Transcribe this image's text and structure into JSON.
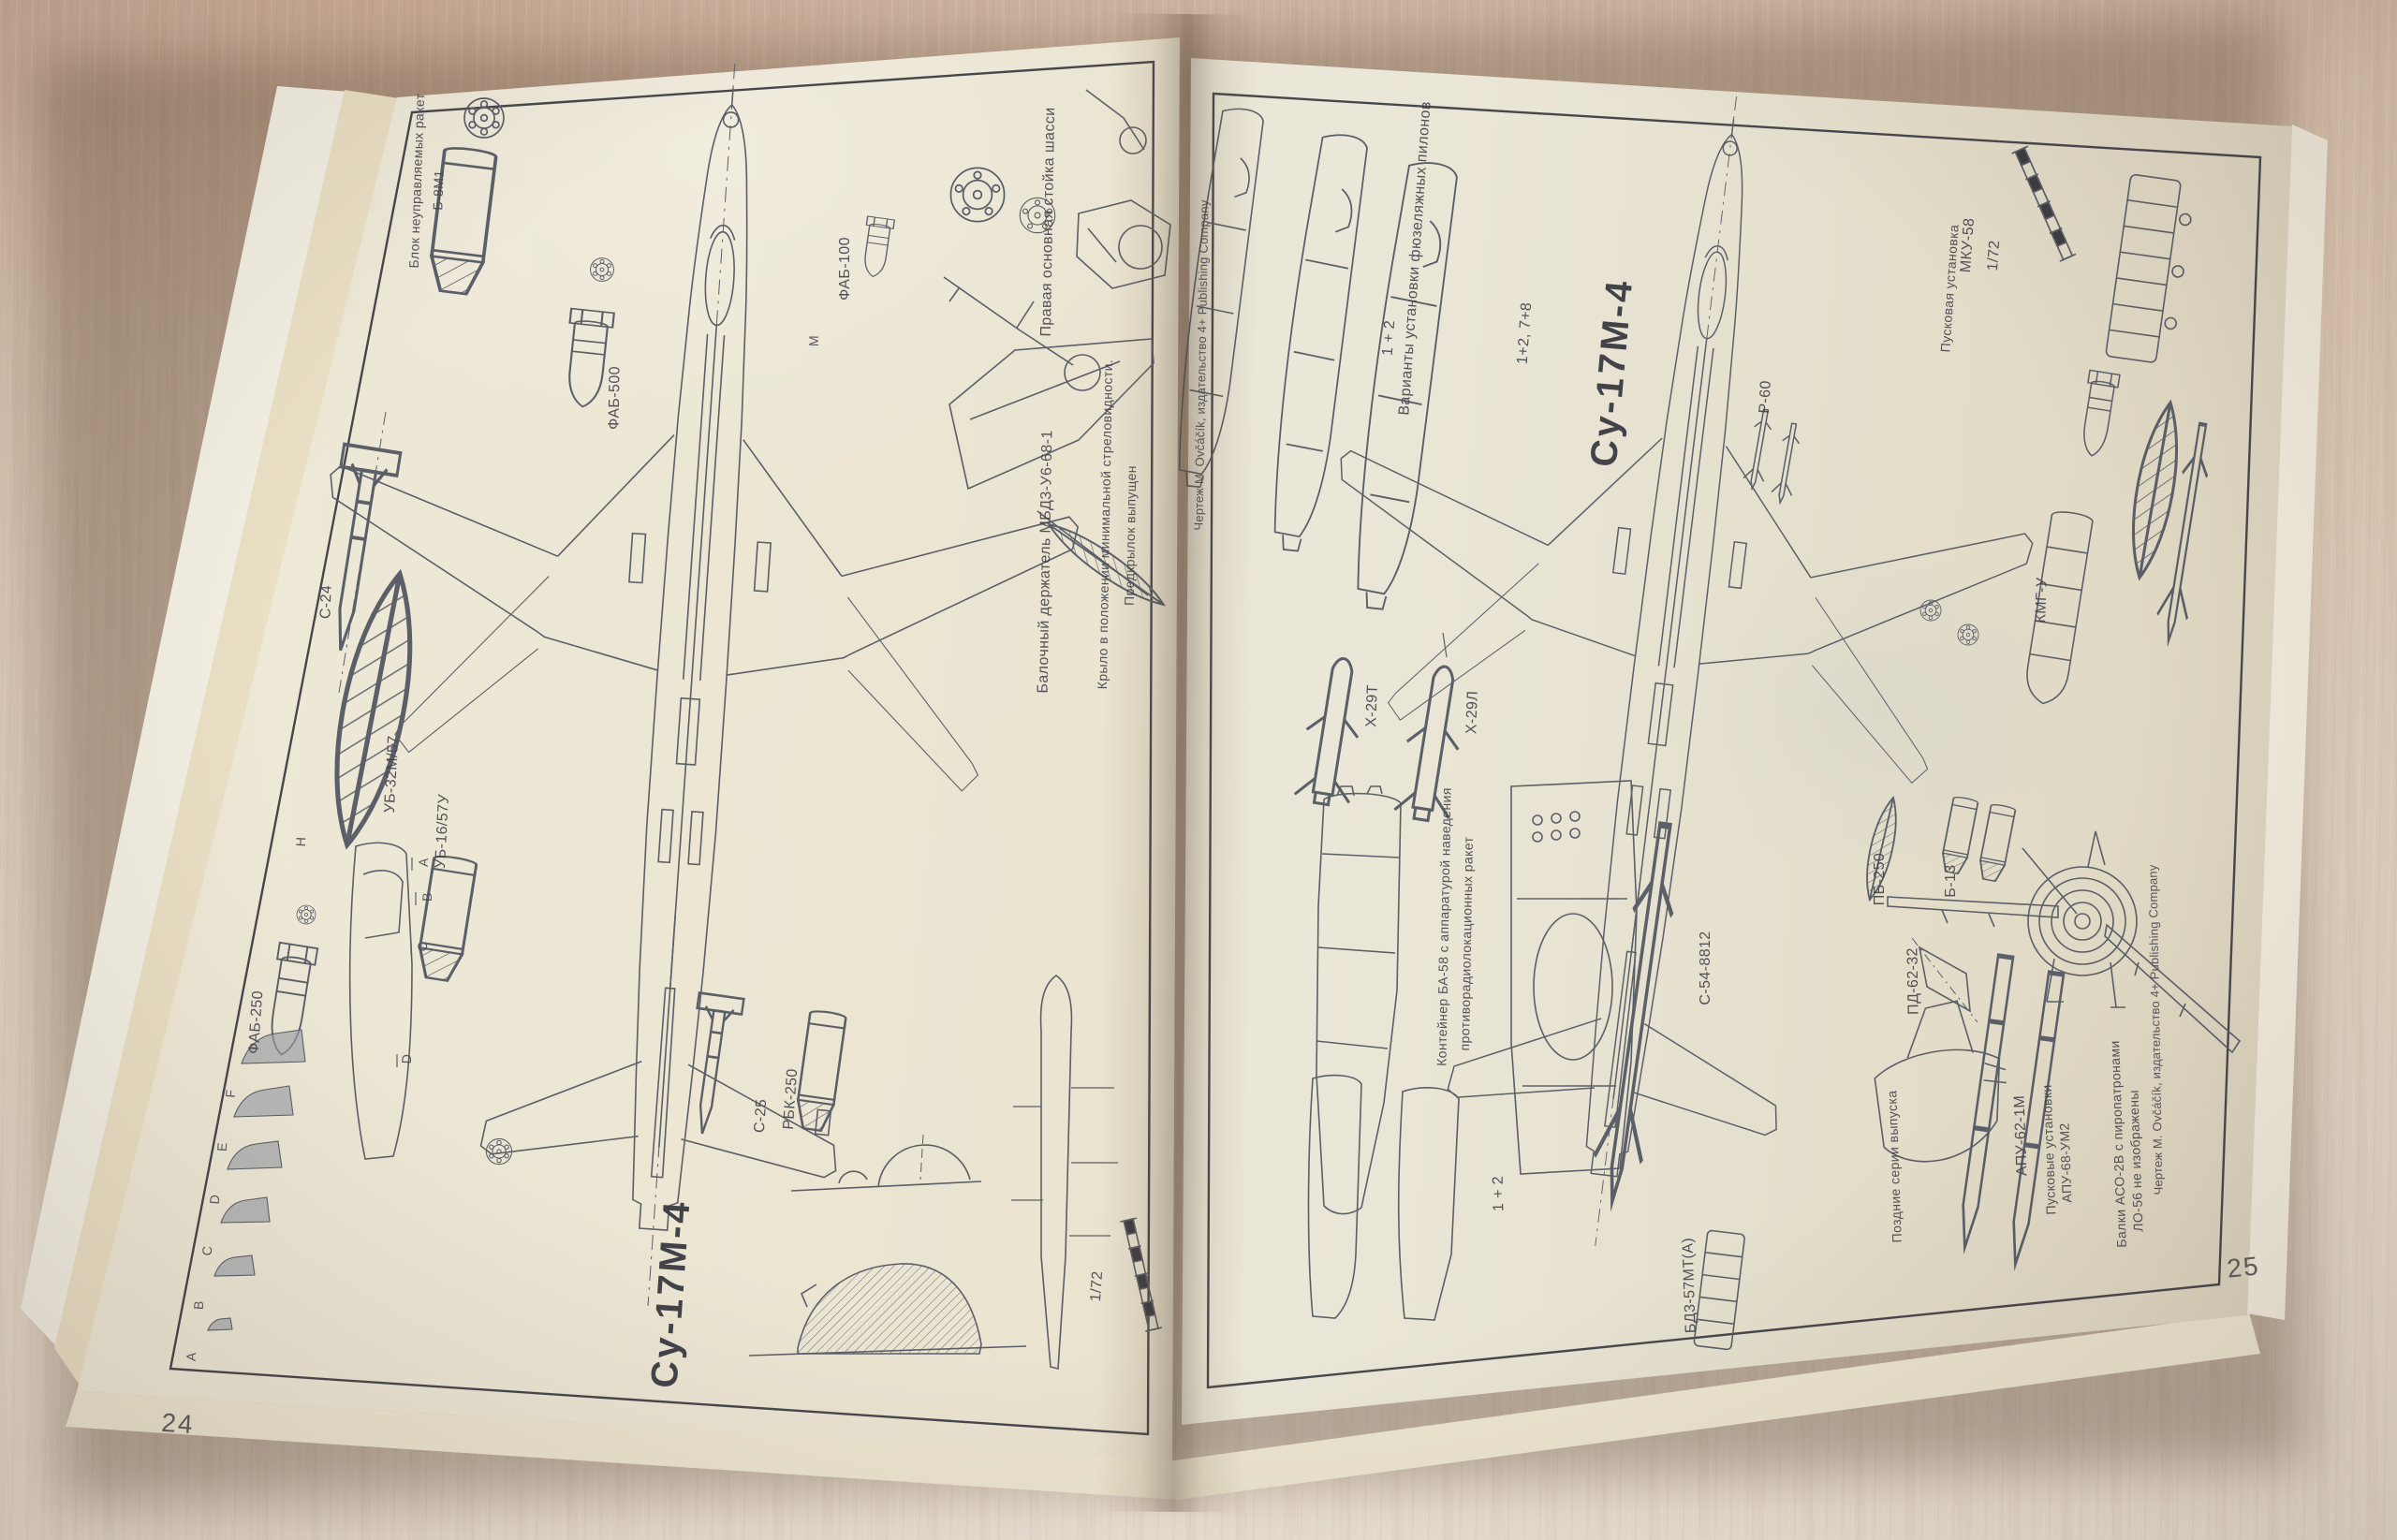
{
  "colors": {
    "paper": "#e9e3d0",
    "wood": "#dcc7b2",
    "ink": "#4a4c54"
  },
  "book": {
    "left_page": {
      "page_number": "24",
      "aircraft_title": "Су-17М-4",
      "scale_label": "1/72",
      "credit": "Чертеж М. Ovčáčík, издательство 4+ Publishing Company",
      "labels": {
        "b8_block_line1": "Блок неуправляемых ракет",
        "b8_block_line2": "Б-8М1",
        "s24": "С-24",
        "ub32": "УБ-32М/57",
        "ub16": "УБ-16/57У",
        "fab250": "ФАБ-250",
        "fab500": "ФАБ-500",
        "fab100": "ФАБ-100",
        "s25": "С-25",
        "rbk250": "РБК-250",
        "gear": "Правая основная стойка шасси",
        "mbd": "Балочный держатель МБД3-У6-68-1",
        "wing_line1": "Крыло в положении минимальной стреловидности.",
        "wing_line2": "Предкрылок выпущен"
      },
      "markers": {
        "a": "A",
        "b": "B",
        "c": "C",
        "d": "D",
        "e": "E",
        "f": "F",
        "m": "M",
        "h": "H"
      }
    },
    "right_page": {
      "page_number": "25",
      "aircraft_title": "Су-17М-4",
      "scale_label": "1/72",
      "credit": "Чертеж М. Ovčáčík, издательство 4+ Publishing Company",
      "labels": {
        "variants": "Варианты установки фюзеляжных пилонов",
        "v12": "1 + 2",
        "v1278": "1+2, 7+8",
        "r60": "Р-60",
        "kh29t": "Х-29Т",
        "kh29l": "Х-29Л",
        "ba58_line1": "Контейнер БА-58 с аппаратурой наведения",
        "ba58_line2": "противорадиолокационных ракет",
        "s54": "С-54-8812",
        "pb250": "ПБ-250",
        "b13": "Б-13",
        "pd6232": "ПД-62-32",
        "apu62": "АПУ-62-1М",
        "pu": "Пусковые установки",
        "apu68": "АПУ-68-УМ2",
        "late_series": "Поздние серии выпуска",
        "aso_line1": "Балки АСО-2В с пиропатронами",
        "aso_line2": "ЛО-56 не изображены",
        "mku_line1": "Пусковая установка",
        "mku_line2": "МКУ-58",
        "kmgu": "КМГ-У",
        "v12b": "1 + 2",
        "bd3": "БД3-57МТ(А)"
      }
    }
  }
}
